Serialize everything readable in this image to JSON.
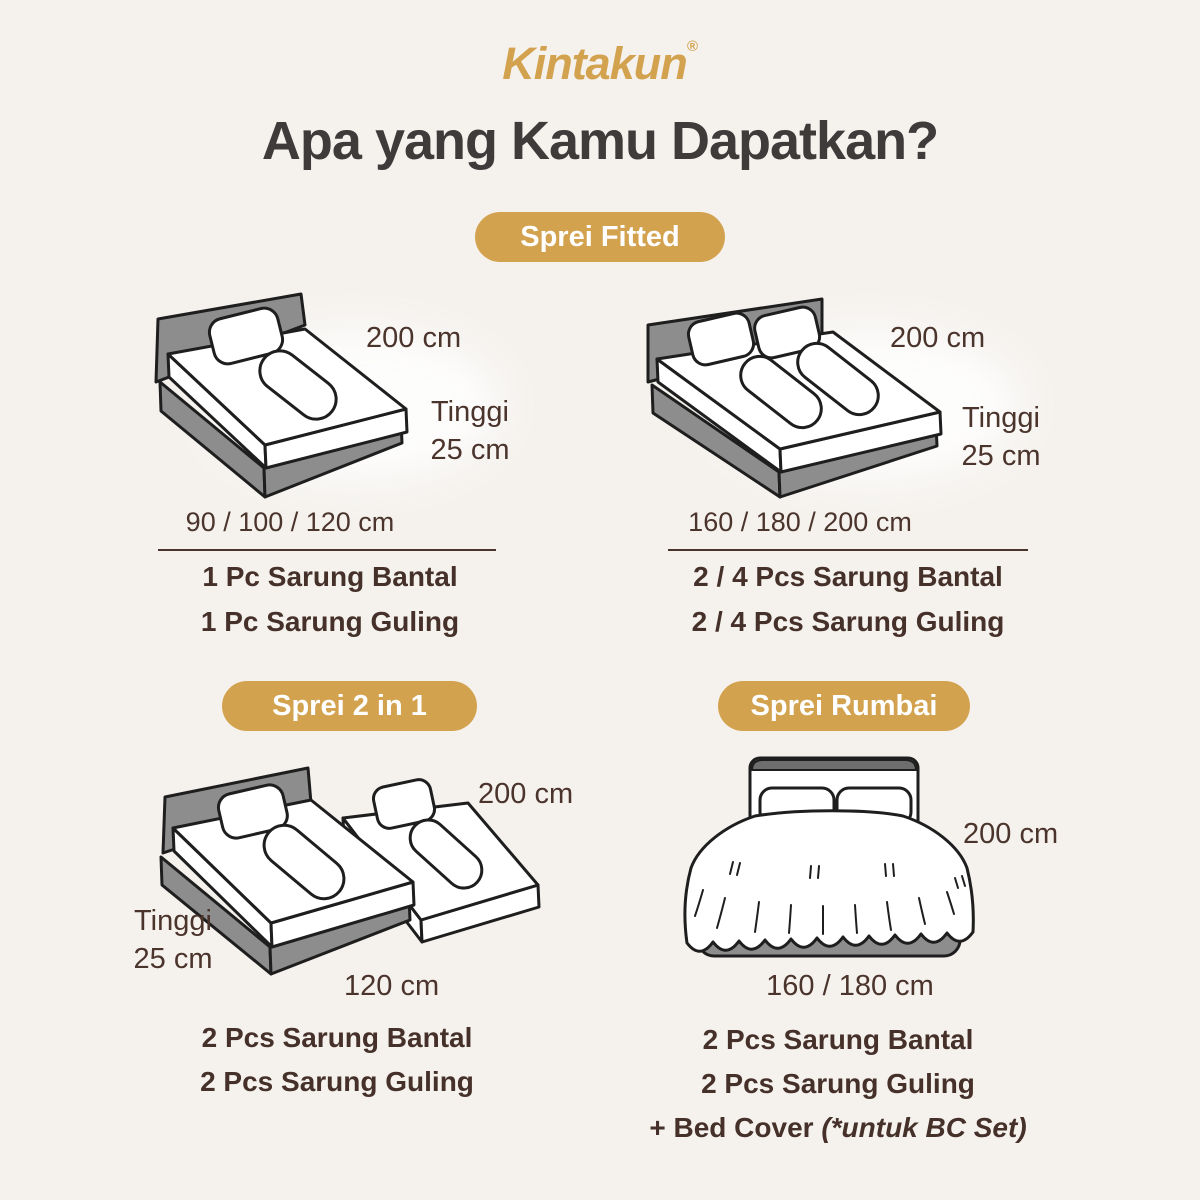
{
  "colors": {
    "background": "#F5F2EE",
    "gold_accent": "#D3A24F",
    "heading_text": "#3F3B3B",
    "body_text": "#4B342C",
    "bed_frame_gray": "#8D8D8D"
  },
  "brand": {
    "name": "Kintakun",
    "registered_mark": "®"
  },
  "heading": "Apa yang Kamu Dapatkan?",
  "sections": {
    "fitted": {
      "badge_label": "Sprei Fitted",
      "single": {
        "width_label": "200 cm",
        "height_label_line1": "Tinggi",
        "height_label_line2": "25 cm",
        "available_sizes": "90 / 100 / 120 cm",
        "contents": [
          "1 Pc Sarung Bantal",
          "1 Pc Sarung Guling"
        ]
      },
      "double": {
        "width_label": "200 cm",
        "height_label_line1": "Tinggi",
        "height_label_line2": "25 cm",
        "available_sizes": "160 / 180 / 200 cm",
        "contents": [
          "2 / 4 Pcs Sarung Bantal",
          "2 / 4 Pcs Sarung Guling"
        ]
      }
    },
    "two_in_one": {
      "badge_label": "Sprei 2 in 1",
      "width_label": "200 cm",
      "height_label_line1": "Tinggi",
      "height_label_line2": "25 cm",
      "length_label": "120 cm",
      "contents": [
        "2 Pcs Sarung Bantal",
        "2 Pcs Sarung Guling"
      ]
    },
    "rumbai": {
      "badge_label": "Sprei Rumbai",
      "width_label": "200 cm",
      "size_label": "160 / 180 cm",
      "contents": [
        "2 Pcs Sarung Bantal",
        "2 Pcs Sarung Guling"
      ],
      "bedcover_note_normal": "+ Bed Cover ",
      "bedcover_note_italic": "(*untuk BC Set)"
    }
  }
}
